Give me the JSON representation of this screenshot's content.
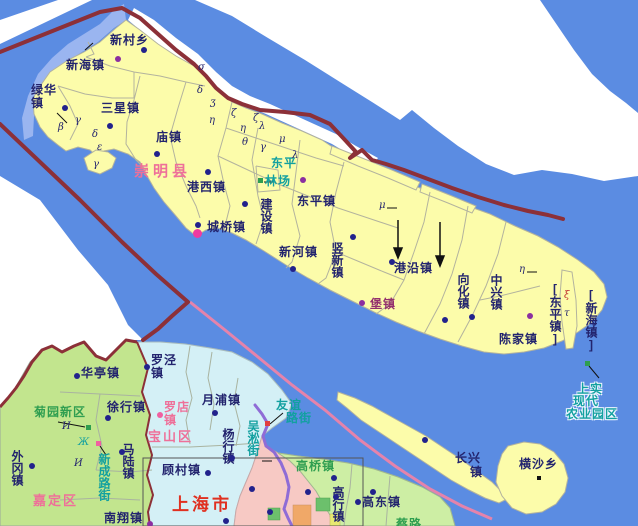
{
  "map_name": "chongming-county-map",
  "colors": {
    "water": "#5b8ce2",
    "shallow_water": "#9ab5f0",
    "island_fill": "#fcfcaa",
    "jiading_fill": "#c2e58e",
    "baoshan_fill": "#d4f0f6",
    "pudong_fill": "#cdeea4",
    "urban_fill": "#f7c9c4",
    "orange_patch": "#f0a868",
    "green_patch": "#6cc06c",
    "province_boundary": "#8c3038",
    "pink_boundary": "#e583ab",
    "purple_boundary": "#8f6cd6",
    "label_navy": "#23246e",
    "label_pink": "#ee7099",
    "label_red": "#e03020",
    "label_teal": "#12a0a0",
    "label_green": "#2f9e50",
    "label_purple": "#93306d"
  },
  "labels": [
    {
      "id": "xincunxiang",
      "text": "新村乡",
      "x": 110,
      "y": 34,
      "cls": ""
    },
    {
      "id": "xinhaizhen",
      "text": "新海镇",
      "x": 66,
      "y": 59,
      "cls": ""
    },
    {
      "id": "luhuazhen",
      "text": "绿华\n镇",
      "x": 31,
      "y": 84,
      "cls": ""
    },
    {
      "id": "sanxingzhen",
      "text": "三星镇",
      "x": 101,
      "y": 102,
      "cls": ""
    },
    {
      "id": "miaozhen",
      "text": "庙镇",
      "x": 156,
      "y": 131,
      "cls": ""
    },
    {
      "id": "chongmingxian",
      "text": "崇明县",
      "x": 134,
      "y": 165,
      "cls": "county"
    },
    {
      "id": "gangxizhen",
      "text": "港西镇",
      "x": 187,
      "y": 181,
      "cls": ""
    },
    {
      "id": "dongping-1",
      "text": "东平",
      "x": 271,
      "y": 157,
      "cls": "teal"
    },
    {
      "id": "dongping-2",
      "text": "林场",
      "x": 265,
      "y": 175,
      "cls": "teal"
    },
    {
      "id": "dongpingzhen",
      "text": "东平镇",
      "x": 297,
      "y": 195,
      "cls": ""
    },
    {
      "id": "jianshezhen",
      "text": "建设镇",
      "x": 259,
      "y": 198,
      "cls": "v"
    },
    {
      "id": "chengqiaozhen",
      "text": "城桥镇",
      "x": 207,
      "y": 221,
      "cls": ""
    },
    {
      "id": "xinhezhen",
      "text": "新河镇",
      "x": 279,
      "y": 246,
      "cls": ""
    },
    {
      "id": "shuxinzhen",
      "text": "竖新镇",
      "x": 330,
      "y": 242,
      "cls": "v"
    },
    {
      "id": "gangyanzhen",
      "text": "港沿镇",
      "x": 394,
      "y": 262,
      "cls": ""
    },
    {
      "id": "baozhen",
      "text": "堡镇",
      "x": 370,
      "y": 298,
      "cls": "purple"
    },
    {
      "id": "xianghuazhen",
      "text": "向化镇",
      "x": 456,
      "y": 273,
      "cls": "v"
    },
    {
      "id": "zhongxingzhen",
      "text": "中兴镇",
      "x": 489,
      "y": 274,
      "cls": "v"
    },
    {
      "id": "chenjiazhen",
      "text": "陈家镇",
      "x": 499,
      "y": 333,
      "cls": ""
    },
    {
      "id": "dongpingzhen-bracket",
      "text": "[东平镇]",
      "x": 548,
      "y": 282,
      "cls": "v"
    },
    {
      "id": "xinhaizhen-bracket",
      "text": "[新海镇]",
      "x": 584,
      "y": 288,
      "cls": "v"
    },
    {
      "id": "hengshaxiang",
      "text": "横沙乡",
      "x": 519,
      "y": 458,
      "cls": ""
    },
    {
      "id": "changxing-1",
      "text": "长兴",
      "x": 455,
      "y": 452,
      "cls": ""
    },
    {
      "id": "changxing-2",
      "text": "镇",
      "x": 470,
      "y": 466,
      "cls": ""
    },
    {
      "id": "shangshi-1",
      "text": "上实",
      "x": 577,
      "y": 383,
      "cls": "halo"
    },
    {
      "id": "shangshi-2",
      "text": "现代",
      "x": 573,
      "y": 395,
      "cls": "halo"
    },
    {
      "id": "shangshi-3",
      "text": "农业园区",
      "x": 566,
      "y": 408,
      "cls": "halo"
    },
    {
      "id": "huatingzhen",
      "text": "华亭镇",
      "x": 81,
      "y": 367,
      "cls": ""
    },
    {
      "id": "luojingzhen",
      "text": "罗泾\n镇",
      "x": 151,
      "y": 354,
      "cls": ""
    },
    {
      "id": "yuepuzhen",
      "text": "月浦镇",
      "x": 202,
      "y": 394,
      "cls": ""
    },
    {
      "id": "xuhangzhen",
      "text": "徐行镇",
      "x": 107,
      "y": 401,
      "cls": ""
    },
    {
      "id": "juyuanxinqu",
      "text": "菊园新区",
      "x": 34,
      "y": 406,
      "cls": "green"
    },
    {
      "id": "luodianzhen",
      "text": "罗店\n镇",
      "x": 164,
      "y": 401,
      "cls": "pinktown"
    },
    {
      "id": "baoshanqu",
      "text": "宝山区",
      "x": 148,
      "y": 430,
      "cls": "district"
    },
    {
      "id": "yanghangzhen",
      "text": "杨行镇",
      "x": 221,
      "y": 428,
      "cls": "v"
    },
    {
      "id": "wusongjie",
      "text": "吴淞街",
      "x": 246,
      "y": 420,
      "cls": "v teal"
    },
    {
      "id": "youyi-1",
      "text": "友谊",
      "x": 276,
      "y": 399,
      "cls": "teal"
    },
    {
      "id": "youyi-2",
      "text": "路街",
      "x": 286,
      "y": 412,
      "cls": "teal"
    },
    {
      "id": "waigangzhen",
      "text": "外冈镇",
      "x": 10,
      "y": 450,
      "cls": "v"
    },
    {
      "id": "xinchenglujie",
      "text": "新成路街",
      "x": 97,
      "y": 453,
      "cls": "v teal"
    },
    {
      "id": "maluzhen",
      "text": "马陆镇",
      "x": 121,
      "y": 443,
      "cls": "v"
    },
    {
      "id": "gucunzhen",
      "text": "顾村镇",
      "x": 162,
      "y": 464,
      "cls": ""
    },
    {
      "id": "jiadingqu",
      "text": "嘉定区",
      "x": 33,
      "y": 494,
      "cls": "district"
    },
    {
      "id": "nanxiangzhen",
      "text": "南翔镇",
      "x": 104,
      "y": 512,
      "cls": ""
    },
    {
      "id": "shanghaishi",
      "text": "上海市",
      "x": 172,
      "y": 498,
      "cls": "city"
    },
    {
      "id": "gaoqiaozhen",
      "text": "高桥镇",
      "x": 296,
      "y": 460,
      "cls": "green"
    },
    {
      "id": "gaohangzhen",
      "text": "高行镇",
      "x": 331,
      "y": 486,
      "cls": "v"
    },
    {
      "id": "gaodongzhen",
      "text": "高东镇",
      "x": 362,
      "y": 496,
      "cls": ""
    },
    {
      "id": "cailu",
      "text": "蔡路",
      "x": 396,
      "y": 518,
      "cls": "green"
    }
  ],
  "markers": [
    {
      "id": "dot-xincun",
      "cls": "dot-navy",
      "x": 144,
      "y": 50
    },
    {
      "id": "dot-xinhai",
      "cls": "dot-purple",
      "x": 118,
      "y": 59
    },
    {
      "id": "dot-luhua",
      "cls": "dot-navy",
      "x": 65,
      "y": 108
    },
    {
      "id": "dot-sanxing",
      "cls": "dot-navy",
      "x": 110,
      "y": 126
    },
    {
      "id": "dot-miao",
      "cls": "dot-navy",
      "x": 157,
      "y": 154
    },
    {
      "id": "dot-gangxi",
      "cls": "dot-navy",
      "x": 208,
      "y": 172
    },
    {
      "id": "dot-dongping",
      "cls": "dot-purple",
      "x": 303,
      "y": 180
    },
    {
      "id": "dot-jianshe",
      "cls": "dot-navy",
      "x": 245,
      "y": 204
    },
    {
      "id": "dot-chengqiao",
      "cls": "dot-navy",
      "x": 198,
      "y": 225
    },
    {
      "id": "dot-chengqiao-seat",
      "cls": "dot-magenta",
      "x": 197,
      "y": 233
    },
    {
      "id": "dot-xinhe",
      "cls": "dot-navy",
      "x": 293,
      "y": 269
    },
    {
      "id": "dot-shuxin",
      "cls": "dot-navy",
      "x": 353,
      "y": 237
    },
    {
      "id": "dot-gangyan",
      "cls": "dot-navy",
      "x": 392,
      "y": 262
    },
    {
      "id": "dot-baozhen",
      "cls": "dot-purple",
      "x": 362,
      "y": 303
    },
    {
      "id": "dot-xianghua",
      "cls": "dot-navy",
      "x": 445,
      "y": 320
    },
    {
      "id": "dot-zhongxing",
      "cls": "dot-navy",
      "x": 472,
      "y": 317
    },
    {
      "id": "dot-chenjia",
      "cls": "dot-purple",
      "x": 530,
      "y": 316
    },
    {
      "id": "dot-changxing",
      "cls": "dot-navy",
      "x": 425,
      "y": 440
    },
    {
      "id": "sq-hengsha",
      "cls": "sq-black",
      "x": 539,
      "y": 478
    },
    {
      "id": "sq-linchang",
      "cls": "sq-green",
      "x": 260,
      "y": 180
    },
    {
      "id": "sq-shangshi",
      "cls": "sq-green",
      "x": 587,
      "y": 363
    },
    {
      "id": "sq-juyuan",
      "cls": "sq-green",
      "x": 88,
      "y": 427
    },
    {
      "id": "sq-xincheng",
      "cls": "sq-pink",
      "x": 98,
      "y": 443
    },
    {
      "id": "sq-youyi",
      "cls": "sq-red",
      "x": 267,
      "y": 423
    },
    {
      "id": "dot-huating",
      "cls": "dot-navy",
      "x": 77,
      "y": 376
    },
    {
      "id": "dot-luojing",
      "cls": "dot-navy",
      "x": 147,
      "y": 367
    },
    {
      "id": "dot-yuepu",
      "cls": "dot-navy",
      "x": 215,
      "y": 413
    },
    {
      "id": "dot-luodian",
      "cls": "dot-pink",
      "x": 160,
      "y": 415
    },
    {
      "id": "dot-xuhang",
      "cls": "dot-navy",
      "x": 108,
      "y": 418
    },
    {
      "id": "dot-waigang",
      "cls": "dot-navy",
      "x": 32,
      "y": 466
    },
    {
      "id": "dot-malu",
      "cls": "dot-navy",
      "x": 122,
      "y": 452
    },
    {
      "id": "dot-yanghang",
      "cls": "dot-navy",
      "x": 232,
      "y": 458
    },
    {
      "id": "dot-gucun",
      "cls": "dot-navy",
      "x": 208,
      "y": 473
    },
    {
      "id": "dot-nanxiang",
      "cls": "dot-purple",
      "x": 150,
      "y": 524
    },
    {
      "id": "dot-gaoqiao",
      "cls": "dot-navy",
      "x": 334,
      "y": 478
    },
    {
      "id": "dot-gaodong",
      "cls": "dot-navy",
      "x": 373,
      "y": 492
    },
    {
      "id": "dot-urban-1",
      "cls": "dot-navy",
      "x": 252,
      "y": 489
    },
    {
      "id": "dot-urban-2",
      "cls": "dot-navy",
      "x": 270,
      "y": 512
    },
    {
      "id": "dot-urban-3",
      "cls": "dot-navy",
      "x": 308,
      "y": 492
    },
    {
      "id": "dot-urban-4",
      "cls": "dot-navy",
      "x": 336,
      "y": 497
    },
    {
      "id": "dot-urban-5",
      "cls": "dot-navy",
      "x": 358,
      "y": 502
    },
    {
      "id": "dot-urban-6",
      "cls": "dot-navy",
      "x": 226,
      "y": 521
    }
  ],
  "symbols": [
    {
      "t": "β",
      "x": 58,
      "y": 122,
      "cls": ""
    },
    {
      "t": "γ",
      "x": 75,
      "y": 115,
      "cls": ""
    },
    {
      "t": "δ",
      "x": 92,
      "y": 129,
      "cls": ""
    },
    {
      "t": "ε",
      "x": 97,
      "y": 142,
      "cls": ""
    },
    {
      "t": "γ",
      "x": 93,
      "y": 159,
      "cls": ""
    },
    {
      "t": "σ",
      "x": 198,
      "y": 62,
      "cls": ""
    },
    {
      "t": "δ",
      "x": 197,
      "y": 85,
      "cls": ""
    },
    {
      "t": "ʒ",
      "x": 210,
      "y": 97,
      "cls": ""
    },
    {
      "t": "η",
      "x": 209,
      "y": 115,
      "cls": ""
    },
    {
      "t": "ζ",
      "x": 231,
      "y": 108,
      "cls": ""
    },
    {
      "t": "η",
      "x": 240,
      "y": 123,
      "cls": ""
    },
    {
      "t": "ζ",
      "x": 253,
      "y": 113,
      "cls": ""
    },
    {
      "t": "λ",
      "x": 259,
      "y": 121,
      "cls": ""
    },
    {
      "t": "θ",
      "x": 242,
      "y": 137,
      "cls": ""
    },
    {
      "t": "γ",
      "x": 260,
      "y": 142,
      "cls": ""
    },
    {
      "t": "μ",
      "x": 279,
      "y": 134,
      "cls": ""
    },
    {
      "t": "λ",
      "x": 292,
      "y": 150,
      "cls": ""
    },
    {
      "t": "μ",
      "x": 379,
      "y": 200,
      "cls": ""
    },
    {
      "t": "η",
      "x": 519,
      "y": 264,
      "cls": ""
    },
    {
      "t": "ξ",
      "x": 564,
      "y": 290,
      "cls": "red"
    },
    {
      "t": "τ",
      "x": 564,
      "y": 308,
      "cls": ""
    },
    {
      "t": "И",
      "x": 62,
      "y": 421,
      "cls": ""
    },
    {
      "t": "Ж",
      "x": 78,
      "y": 437,
      "cls": "tealc"
    },
    {
      "t": "И",
      "x": 74,
      "y": 458,
      "cls": ""
    }
  ]
}
